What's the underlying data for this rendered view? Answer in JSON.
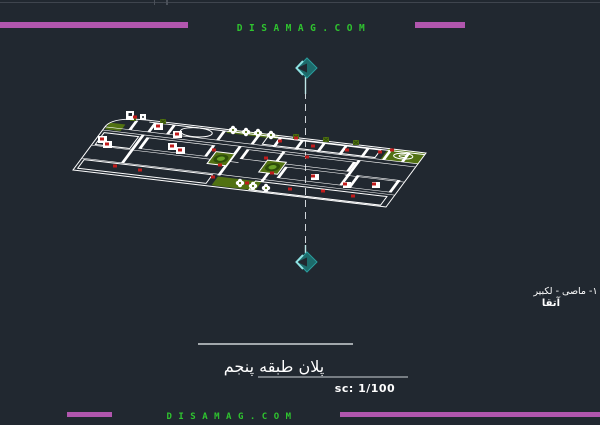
{
  "header": {
    "site_text": "DISAMAG.COM"
  },
  "footer": {
    "site_text": "DISAMAG.COM"
  },
  "title_block": {
    "drawing_title": "پلان طبقه پنجم",
    "scale_label": "sc: 1/100"
  },
  "side_annotation": {
    "line1": "١- ماصى - لكبير -",
    "line2": "آتقا"
  },
  "colors": {
    "background": "#212830",
    "accent_bar_purple": "#b156ae",
    "brand_green": "#2fc42f",
    "cad_line_white": "#ffffff",
    "cad_red": "#c01c1c",
    "cad_olive": "#517112",
    "cad_plant_green": "#69a026",
    "cad_teal": "#1d6b6b",
    "teal_highlight": "#8fe3e3",
    "section_dash": "#d0d5da"
  },
  "icons": {
    "top_marker": "section-arrow-icon",
    "bottom_marker": "section-arrow-icon"
  }
}
